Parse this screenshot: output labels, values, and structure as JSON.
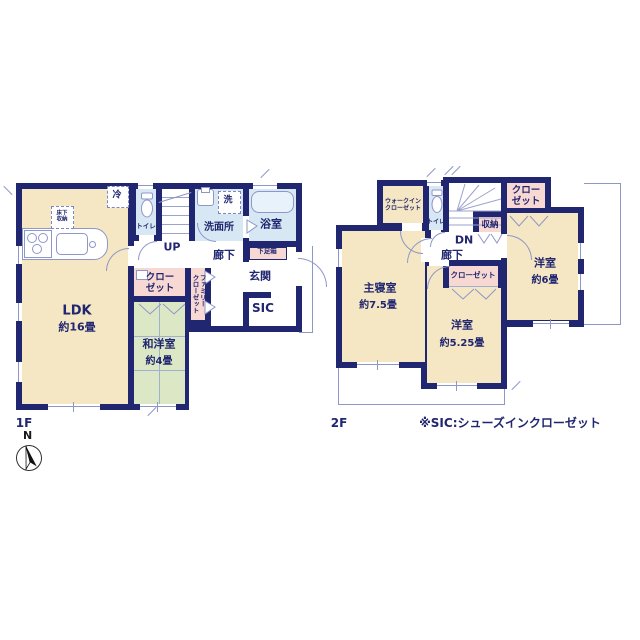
{
  "floor1": {
    "label": "1F",
    "ldk": {
      "name": "LDK",
      "area": "約16畳"
    },
    "washitsu": {
      "name": "和洋室",
      "area": "約4畳"
    },
    "closet": {
      "line1": "クロー",
      "line2": "ゼット"
    },
    "family_closet": {
      "line1": "ファミリー",
      "line2": "クローゼット"
    },
    "toilet": "トイレ",
    "stairs_up": "UP",
    "washer": "洗",
    "washroom": "洗面所",
    "bathroom": "浴室",
    "hallway": "廊下",
    "shoe_box": "下足箱",
    "entrance": "玄関",
    "sic": "SIC",
    "fridge": "冷",
    "underfloor": {
      "line1": "床下",
      "line2": "収納"
    }
  },
  "floor2": {
    "label": "2F",
    "master": {
      "name": "主寝室",
      "area": "約7.5畳"
    },
    "west_a": {
      "name": "洋室",
      "area": "約5.25畳"
    },
    "west_b": {
      "name": "洋室",
      "area": "約6畳"
    },
    "wic": {
      "line1": "ウォークイン",
      "line2": "クローゼット"
    },
    "toilet": "トイレ",
    "stairs_dn": "DN",
    "hallway": "廊下",
    "storage": "収納",
    "closet_top": {
      "line1": "クロー",
      "line2": "ゼット"
    },
    "closet_mid": "クローゼット"
  },
  "footer": {
    "note": "※SIC:シューズインクローゼット",
    "compass": "N"
  },
  "colors": {
    "wall": "#20266f",
    "room_cream": "#f6e7c4",
    "room_green": "#dce8c5",
    "room_blue": "#d7e7f3",
    "closet_pink": "#f7d8d2",
    "line": "#8d97c8"
  }
}
